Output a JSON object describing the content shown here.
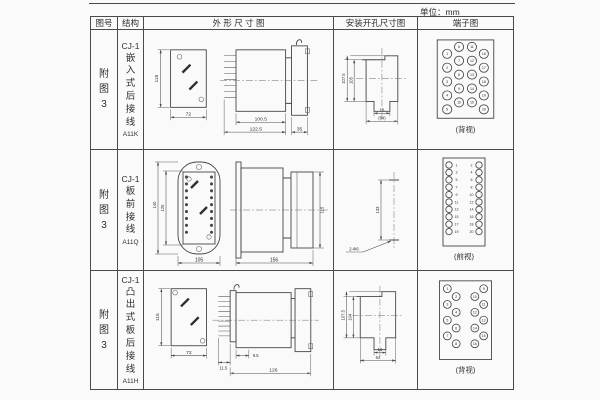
{
  "unit_label": "单位：mm",
  "headers": {
    "fig_no": "图号",
    "structure": "结构",
    "outline": "外 形 尺 寸 图",
    "mounting": "安装开孔尺寸图",
    "terminal": "端子图"
  },
  "rows": [
    {
      "fig_no": "附图3",
      "model": "CJ-1",
      "structure_desc": "嵌入式后接线",
      "code": "A11K",
      "outline": {
        "front_h": "115",
        "front_w": "72",
        "side_w1": "100.5",
        "side_w2": "122.5",
        "side_w3": "35"
      },
      "mounting": {
        "v1": "107.5",
        "v2": "105",
        "h1": "16",
        "h2": "(64)"
      },
      "terminal": {
        "view": "(背视)",
        "circles": {
          "r": 4.6,
          "points": [
            {
              "x": 29,
              "y": 22,
              "n": "1"
            },
            {
              "x": 29,
              "y": 36,
              "n": "2"
            },
            {
              "x": 29,
              "y": 50,
              "n": "3"
            },
            {
              "x": 29,
              "y": 64,
              "n": "4"
            },
            {
              "x": 29,
              "y": 78,
              "n": "5"
            },
            {
              "x": 41,
              "y": 15,
              "n": "6"
            },
            {
              "x": 41,
              "y": 29,
              "n": "7"
            },
            {
              "x": 41,
              "y": 43,
              "n": "8"
            },
            {
              "x": 41,
              "y": 57,
              "n": "9"
            },
            {
              "x": 41,
              "y": 71,
              "n": "10"
            },
            {
              "x": 54,
              "y": 15,
              "n": "11"
            },
            {
              "x": 54,
              "y": 29,
              "n": "12"
            },
            {
              "x": 54,
              "y": 43,
              "n": "13"
            },
            {
              "x": 54,
              "y": 57,
              "n": "14"
            },
            {
              "x": 54,
              "y": 71,
              "n": "15"
            },
            {
              "x": 66,
              "y": 22,
              "n": "16"
            },
            {
              "x": 66,
              "y": 36,
              "n": "17"
            },
            {
              "x": 66,
              "y": 50,
              "n": "18"
            },
            {
              "x": 66,
              "y": 64,
              "n": "19"
            },
            {
              "x": 66,
              "y": 78,
              "n": "20"
            }
          ]
        }
      }
    },
    {
      "fig_no": "附图3",
      "model": "CJ-1",
      "structure_desc": "板前接线",
      "code": "A11Q",
      "outline": {
        "front_h1": "140",
        "front_h2": "125",
        "front_w": "105",
        "side_w": "156",
        "side_h": "115"
      },
      "mounting": {
        "v1": "133",
        "hole_note": "2-Φ6"
      },
      "terminal": {
        "view": "(前视)",
        "circles": {
          "r": 3.2,
          "points": [
            {
              "x": 31,
              "y": 15,
              "n": "1",
              "lx": 38.5
            },
            {
              "x": 31,
              "y": 22.4,
              "n": "3",
              "lx": 38.5
            },
            {
              "x": 31,
              "y": 29.8,
              "n": "5",
              "lx": 38.5
            },
            {
              "x": 31,
              "y": 37.2,
              "n": "7",
              "lx": 38.5
            },
            {
              "x": 31,
              "y": 44.6,
              "n": "9",
              "lx": 38.5
            },
            {
              "x": 31,
              "y": 52,
              "n": "11",
              "lx": 38.5
            },
            {
              "x": 31,
              "y": 59.4,
              "n": "13",
              "lx": 38.5
            },
            {
              "x": 31,
              "y": 66.8,
              "n": "15",
              "lx": 38.5
            },
            {
              "x": 31,
              "y": 74.2,
              "n": "17",
              "lx": 38.5
            },
            {
              "x": 31,
              "y": 81.6,
              "n": "19",
              "lx": 38.5
            },
            {
              "x": 61,
              "y": 15,
              "n": "2",
              "lx": 53.5
            },
            {
              "x": 61,
              "y": 22.4,
              "n": "4",
              "lx": 53.5
            },
            {
              "x": 61,
              "y": 29.8,
              "n": "6",
              "lx": 53.5
            },
            {
              "x": 61,
              "y": 37.2,
              "n": "8",
              "lx": 53.5
            },
            {
              "x": 61,
              "y": 44.6,
              "n": "10",
              "lx": 53.5
            },
            {
              "x": 61,
              "y": 52,
              "n": "12",
              "lx": 53.5
            },
            {
              "x": 61,
              "y": 59.4,
              "n": "14",
              "lx": 53.5
            },
            {
              "x": 61,
              "y": 66.8,
              "n": "16",
              "lx": 53.5
            },
            {
              "x": 61,
              "y": 74.2,
              "n": "18",
              "lx": 53.5
            },
            {
              "x": 61,
              "y": 81.6,
              "n": "20",
              "lx": 53.5
            }
          ]
        }
      }
    },
    {
      "fig_no": "附图3",
      "model": "CJ-1",
      "structure_desc": "凸出式板后接线",
      "code": "A11H",
      "outline": {
        "front_h": "115",
        "front_w": "72",
        "side_w1": "11.5",
        "side_w2": "9.5",
        "side_w3": "126"
      },
      "mounting": {
        "v1": "107.5",
        "v2": "104",
        "h1": "16",
        "h2": "64"
      },
      "terminal": {
        "view": "(背视)",
        "circles": {
          "r": 4,
          "points": [
            {
              "x": 29,
              "y": 16,
              "n": "1"
            },
            {
              "x": 38,
              "y": 24,
              "n": "2"
            },
            {
              "x": 29,
              "y": 32,
              "n": "3"
            },
            {
              "x": 38,
              "y": 40,
              "n": "4"
            },
            {
              "x": 29,
              "y": 48,
              "n": "5"
            },
            {
              "x": 38,
              "y": 56,
              "n": "6"
            },
            {
              "x": 29,
              "y": 64,
              "n": "7"
            },
            {
              "x": 38,
              "y": 72,
              "n": "8"
            },
            {
              "x": 66,
              "y": 16,
              "n": "9"
            },
            {
              "x": 57,
              "y": 24,
              "n": "10"
            },
            {
              "x": 66,
              "y": 32,
              "n": "11"
            },
            {
              "x": 57,
              "y": 40,
              "n": "12"
            },
            {
              "x": 66,
              "y": 48,
              "n": "13"
            },
            {
              "x": 57,
              "y": 56,
              "n": "14"
            },
            {
              "x": 66,
              "y": 64,
              "n": "15"
            },
            {
              "x": 57,
              "y": 72,
              "n": "16"
            }
          ]
        }
      }
    }
  ]
}
